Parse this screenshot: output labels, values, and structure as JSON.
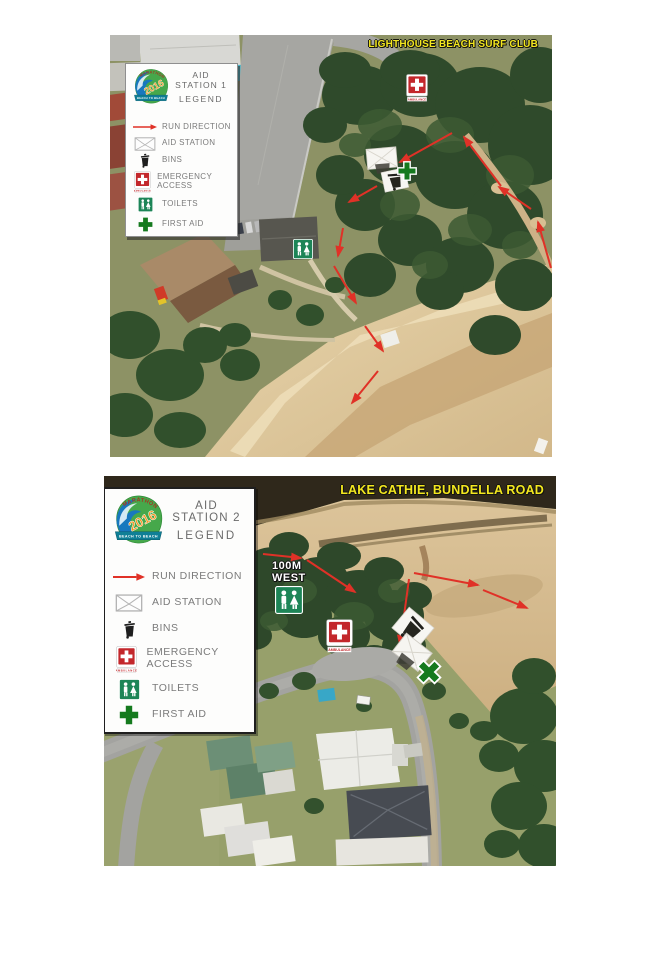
{
  "colors": {
    "title_yellow": "#f3e71f",
    "arrow_red": "#e03127",
    "legend_text": "#7b7b7b",
    "legend_header_text": "#6a6a6a",
    "first_aid_green": "#17791e",
    "toilets_green": "#1d8557",
    "emergency_red": "#c3272b"
  },
  "shared": {
    "ambulance_label": "AMBULANCE",
    "logo": {
      "arc_text": "MARATHON",
      "year": "2016",
      "banner_text": "BEACH TO BEACH"
    }
  },
  "maps": [
    {
      "title": "LIGHTHOUSE BEACH SURF CLUB",
      "legend": {
        "header_line1": "AID STATION 1",
        "header_line2": "LEGEND",
        "items": [
          {
            "icon": "run-direction-arrow-icon",
            "label": "RUN DIRECTION"
          },
          {
            "icon": "aid-station-icon",
            "label": "AID STATION"
          },
          {
            "icon": "bins-icon",
            "label": "BINS"
          },
          {
            "icon": "emergency-access-icon",
            "label": "EMERGENCY ACCESS"
          },
          {
            "icon": "toilets-icon",
            "label": "TOILETS"
          },
          {
            "icon": "first-aid-icon",
            "label": "FIRST AID"
          }
        ]
      },
      "arrows": [
        [
          342,
          98,
          290,
          127
        ],
        [
          267,
          151,
          239,
          167
        ],
        [
          233,
          193,
          228,
          221
        ],
        [
          224,
          231,
          246,
          268
        ],
        [
          255,
          291,
          273,
          316
        ],
        [
          268,
          336,
          242,
          368
        ],
        [
          441,
          233,
          428,
          187
        ],
        [
          421,
          174,
          389,
          152
        ],
        [
          391,
          151,
          354,
          102
        ]
      ],
      "markers": [
        {
          "type": "emergency",
          "x": 296,
          "y": 39,
          "w": 22,
          "h": 28,
          "rot": 0
        },
        {
          "type": "marquee",
          "x": 256,
          "y": 112,
          "w": 32,
          "h": 27,
          "rot": -5
        },
        {
          "type": "binbox",
          "x": 272,
          "y": 134,
          "w": 26,
          "h": 23,
          "rot": -12
        },
        {
          "type": "cross",
          "x": 287,
          "y": 126,
          "w": 20,
          "h": 20,
          "rot": 0
        },
        {
          "type": "toilets",
          "x": 183,
          "y": 204,
          "w": 20,
          "h": 20,
          "rot": 0
        }
      ]
    },
    {
      "title": "LAKE CATHIE, BUNDELLA ROAD",
      "map_label": {
        "line1": "100M",
        "line2": "WEST"
      },
      "legend": {
        "header_line1": "AID STATION 2",
        "header_line2": "LEGEND",
        "items": [
          {
            "icon": "run-direction-arrow-icon",
            "label": "RUN DIRECTION"
          },
          {
            "icon": "aid-station-icon",
            "label": "AID STATION"
          },
          {
            "icon": "bins-icon",
            "label": "BINS"
          },
          {
            "icon": "emergency-access-icon",
            "label": "EMERGENCY ACCESS"
          },
          {
            "icon": "toilets-icon",
            "label": "TOILETS"
          },
          {
            "icon": "first-aid-icon",
            "label": "FIRST AID"
          }
        ]
      },
      "arrows": [
        [
          159,
          78,
          197,
          82
        ],
        [
          203,
          84,
          251,
          116
        ],
        [
          305,
          103,
          296,
          169
        ],
        [
          310,
          97,
          374,
          109
        ],
        [
          379,
          114,
          423,
          132
        ]
      ],
      "markers": [
        {
          "type": "toilets",
          "x": 171,
          "y": 110,
          "w": 28,
          "h": 28,
          "rot": 0
        },
        {
          "type": "emergency",
          "x": 222,
          "y": 143,
          "w": 27,
          "h": 34,
          "rot": 0
        },
        {
          "type": "binbox",
          "x": 291,
          "y": 137,
          "w": 35,
          "h": 31,
          "rot": 40
        },
        {
          "type": "marquee",
          "x": 289,
          "y": 163,
          "w": 35,
          "h": 31,
          "rot": 38
        },
        {
          "type": "cross",
          "x": 312,
          "y": 183,
          "w": 26,
          "h": 26,
          "rot": 45
        }
      ]
    }
  ]
}
